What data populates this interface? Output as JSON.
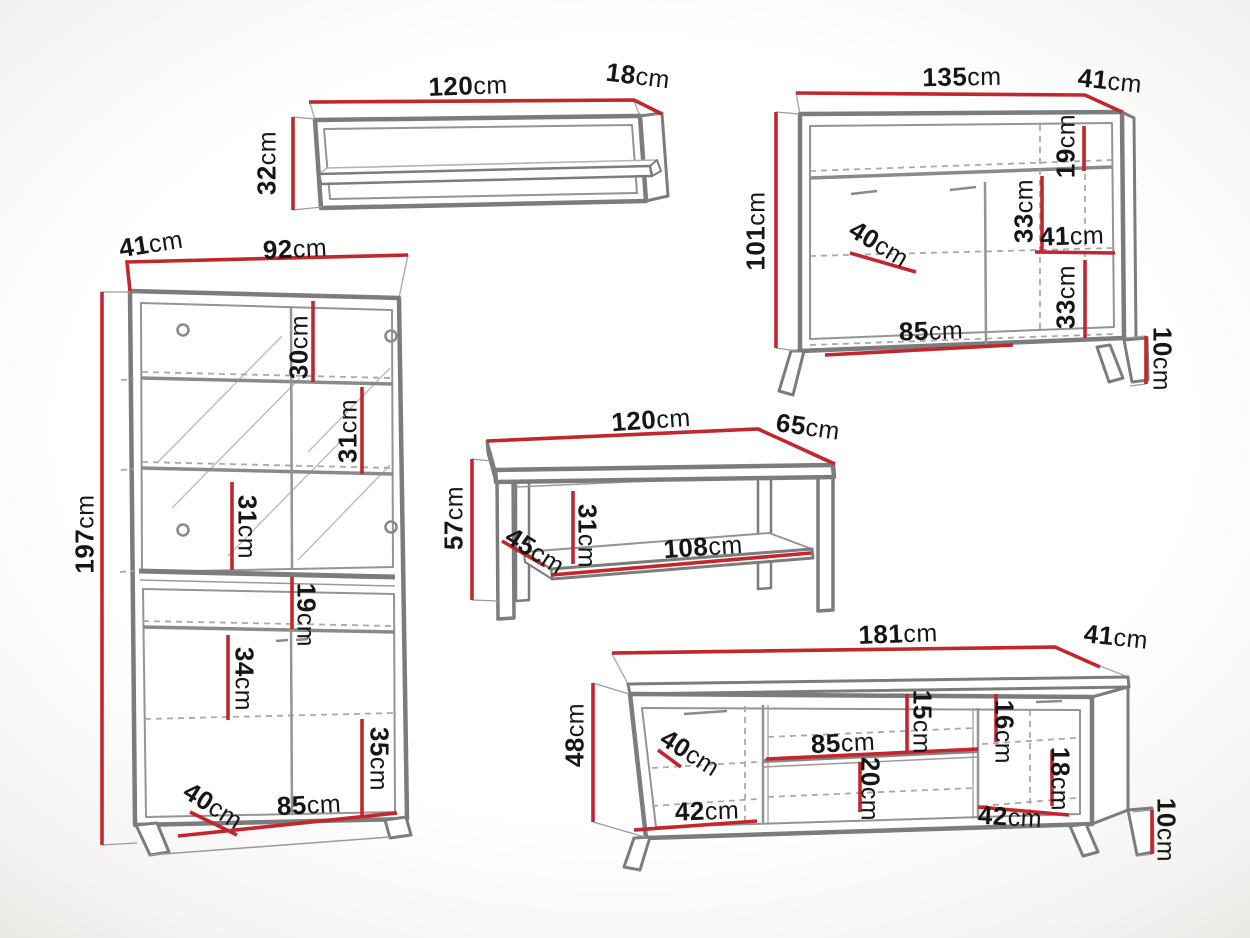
{
  "palette": {
    "background": "#ffffff",
    "vignette_edge": "#e9e8e5",
    "dimension_red": "#c1272d",
    "text_ink": "#161616",
    "outline_dark": "#7c7c7c",
    "outline_mid": "#949494",
    "outline_light": "#b3b3b3"
  },
  "unit": "cm",
  "pieces": {
    "wall_shelf": {
      "label": "wall-shelf",
      "width": {
        "v": "120",
        "u": "cm"
      },
      "depth": {
        "v": "18",
        "u": "cm"
      },
      "height": {
        "v": "32",
        "u": "cm"
      }
    },
    "display_cabinet": {
      "label": "display-cabinet",
      "depth": {
        "v": "41",
        "u": "cm"
      },
      "width": {
        "v": "92",
        "u": "cm"
      },
      "height": {
        "v": "197",
        "u": "cm"
      },
      "glass_shelf_1": {
        "v": "30",
        "u": "cm"
      },
      "glass_shelf_2": {
        "v": "31",
        "u": "cm"
      },
      "glass_shelf_3": {
        "v": "31",
        "u": "cm"
      },
      "niche_height": {
        "v": "19",
        "u": "cm"
      },
      "lower_shelf": {
        "v": "34",
        "u": "cm"
      },
      "lower_bottom": {
        "v": "35",
        "u": "cm"
      },
      "inner_depth": {
        "v": "40",
        "u": "cm"
      },
      "inner_width": {
        "v": "85",
        "u": "cm"
      }
    },
    "sideboard": {
      "label": "sideboard",
      "width": {
        "v": "135",
        "u": "cm"
      },
      "depth": {
        "v": "41",
        "u": "cm"
      },
      "height": {
        "v": "101",
        "u": "cm"
      },
      "top_gap": {
        "v": "19",
        "u": "cm"
      },
      "upper_shelf_gap": {
        "v": "33",
        "u": "cm"
      },
      "right_section_width": {
        "v": "41",
        "u": "cm"
      },
      "inner_depth": {
        "v": "40",
        "u": "cm"
      },
      "lower_shelf_gap": {
        "v": "33",
        "u": "cm"
      },
      "doors_width": {
        "v": "85",
        "u": "cm"
      },
      "leg_height": {
        "v": "10",
        "u": "cm"
      }
    },
    "coffee_table": {
      "label": "coffee-table",
      "width": {
        "v": "120",
        "u": "cm"
      },
      "depth": {
        "v": "65",
        "u": "cm"
      },
      "height": {
        "v": "57",
        "u": "cm"
      },
      "inner_depth": {
        "v": "45",
        "u": "cm"
      },
      "inner_height": {
        "v": "31",
        "u": "cm"
      },
      "shelf_width": {
        "v": "108",
        "u": "cm"
      }
    },
    "tv_stand": {
      "label": "tv-stand",
      "width": {
        "v": "181",
        "u": "cm"
      },
      "depth": {
        "v": "41",
        "u": "cm"
      },
      "height": {
        "v": "48",
        "u": "cm"
      },
      "inner_depth": {
        "v": "40",
        "u": "cm"
      },
      "middle_width": {
        "v": "85",
        "u": "cm"
      },
      "top_gap": {
        "v": "15",
        "u": "cm"
      },
      "right_gap_upper": {
        "v": "16",
        "u": "cm"
      },
      "right_gap_lower": {
        "v": "18",
        "u": "cm"
      },
      "middle_gap": {
        "v": "20",
        "u": "cm"
      },
      "left_door_width": {
        "v": "42",
        "u": "cm"
      },
      "right_door_width": {
        "v": "42",
        "u": "cm"
      },
      "leg_height": {
        "v": "10",
        "u": "cm"
      }
    }
  }
}
